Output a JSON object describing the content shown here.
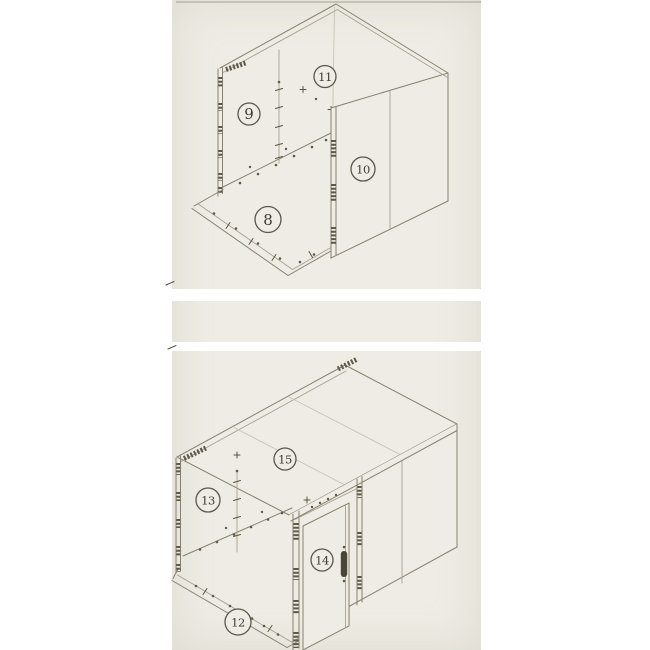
{
  "page": {
    "background": "#ffffff",
    "scan_background": "#eeece4",
    "line_color": "#86826f",
    "accent_dark": "#57533f"
  },
  "diagrams": {
    "top": {
      "labels": [
        {
          "number": "8"
        },
        {
          "number": "9"
        },
        {
          "number": "10"
        },
        {
          "number": "11"
        }
      ]
    },
    "bottom": {
      "labels": [
        {
          "number": "12"
        },
        {
          "number": "13"
        },
        {
          "number": "14"
        },
        {
          "number": "15"
        }
      ]
    }
  }
}
